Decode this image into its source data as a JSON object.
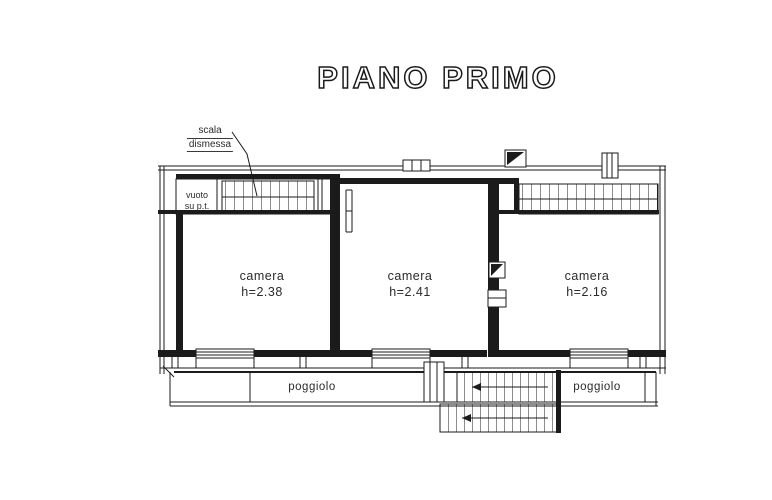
{
  "title": "PIANO PRIMO",
  "annotations": {
    "stair_note": {
      "line1": "scala",
      "line2": "dismessa"
    },
    "void_note": {
      "line1": "vuoto",
      "line2": "su p.t."
    }
  },
  "rooms": [
    {
      "name": "camera",
      "height_label": "h=2.38"
    },
    {
      "name": "camera",
      "height_label": "h=2.41"
    },
    {
      "name": "camera",
      "height_label": "h=2.16"
    }
  ],
  "balconies": [
    {
      "label": "poggiolo"
    },
    {
      "label": "poggiolo"
    }
  ],
  "colors": {
    "ink": "#1b1b1b",
    "paper": "#ffffff"
  }
}
